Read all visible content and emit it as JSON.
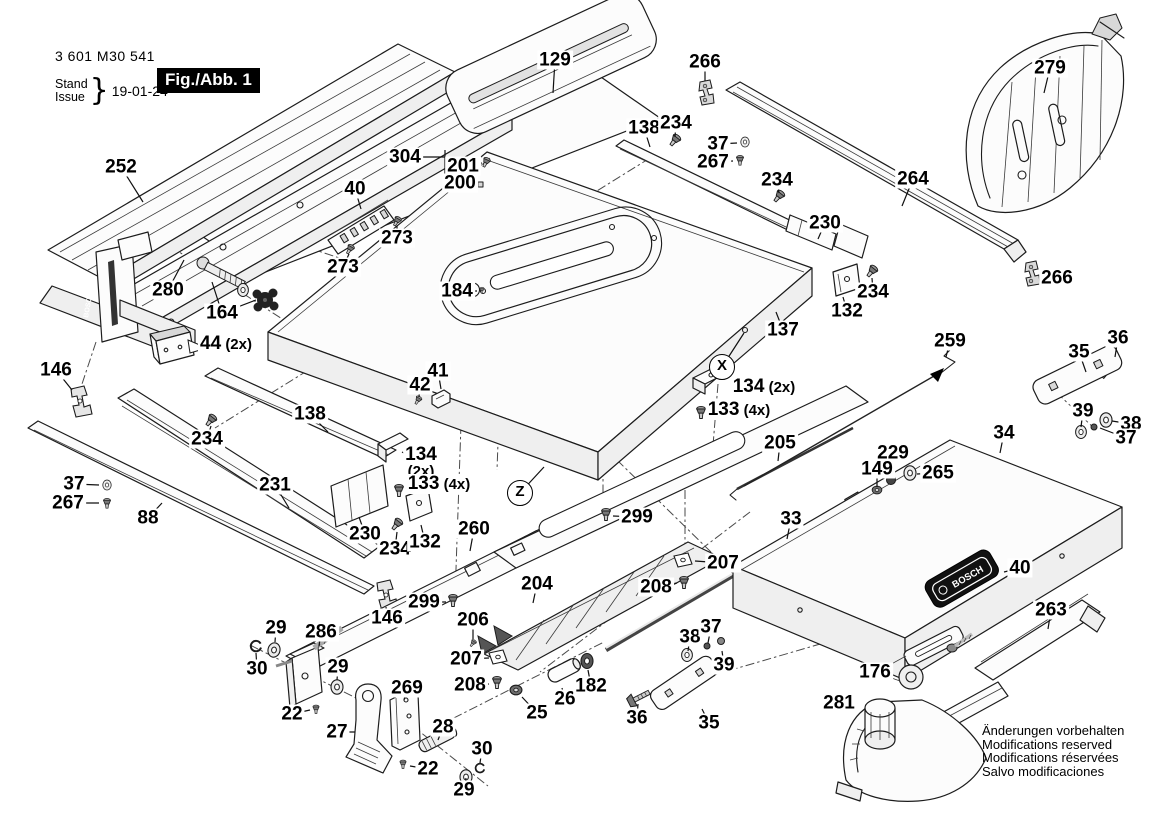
{
  "header": {
    "part_number": "3 601 M30 541",
    "stand_label": "Stand",
    "issue_label": "Issue",
    "date": "19-01-24",
    "figure": "Fig./Abb. 1"
  },
  "brand": "BOSCH",
  "notes": [
    "Änderungen vorbehalten",
    "Modifications reserved",
    "Modifications réservées",
    "Salvo modificaciones"
  ],
  "circled_refs": [
    {
      "t": "X",
      "x": 722,
      "y": 367,
      "lx": 744,
      "ly": 333
    },
    {
      "t": "Z",
      "x": 520,
      "y": 493,
      "lx": 544,
      "ly": 467
    }
  ],
  "callouts": [
    {
      "t": "252",
      "x": 121,
      "y": 167,
      "lx": 143,
      "ly": 202
    },
    {
      "t": "280",
      "x": 168,
      "y": 290,
      "lx": 184,
      "ly": 260
    },
    {
      "t": "164",
      "x": 222,
      "y": 313,
      "lx": 212,
      "ly": 282,
      "l2x": 256,
      "l2y": 300
    },
    {
      "t": "44",
      "s": "(2x)",
      "x": 226,
      "y": 344,
      "lx": 203,
      "ly": 347
    },
    {
      "t": "146",
      "x": 56,
      "y": 370,
      "lx": 72,
      "ly": 390
    },
    {
      "t": "37",
      "x": 74,
      "y": 484,
      "lx": 99,
      "ly": 485
    },
    {
      "t": "267",
      "x": 68,
      "y": 503,
      "lx": 99,
      "ly": 503
    },
    {
      "t": "88",
      "x": 148,
      "y": 518,
      "lx": 162,
      "ly": 503
    },
    {
      "t": "231",
      "x": 275,
      "y": 485,
      "lx": 289,
      "ly": 508
    },
    {
      "t": "234",
      "x": 207,
      "y": 439,
      "lx": 211,
      "ly": 426
    },
    {
      "t": "138",
      "x": 310,
      "y": 414,
      "lx": 328,
      "ly": 432
    },
    {
      "t": "273",
      "x": 397,
      "y": 238,
      "lx": 397,
      "ly": 226
    },
    {
      "t": "273",
      "x": 343,
      "y": 267,
      "lx": 349,
      "ly": 254
    },
    {
      "t": "40",
      "x": 355,
      "y": 189,
      "lx": 361,
      "ly": 209
    },
    {
      "t": "304",
      "x": 405,
      "y": 157,
      "lx": 420,
      "ly": 157
    },
    {
      "t": "201",
      "x": 463,
      "y": 166,
      "lx": 482,
      "ly": 163
    },
    {
      "t": "200",
      "x": 460,
      "y": 183,
      "lx": 477,
      "ly": 184
    },
    {
      "t": "129",
      "x": 555,
      "y": 60,
      "lx": 553,
      "ly": 93
    },
    {
      "t": "266",
      "x": 705,
      "y": 62,
      "lx": 705,
      "ly": 81
    },
    {
      "t": "138",
      "x": 644,
      "y": 128,
      "lx": 650,
      "ly": 147
    },
    {
      "t": "234",
      "x": 676,
      "y": 123,
      "lx": 675,
      "ly": 137
    },
    {
      "t": "37",
      "x": 718,
      "y": 144,
      "lx": 737,
      "ly": 143
    },
    {
      "t": "267",
      "x": 713,
      "y": 162,
      "lx": 733,
      "ly": 161
    },
    {
      "t": "234",
      "x": 777,
      "y": 180,
      "lx": 779,
      "ly": 193
    },
    {
      "t": "264",
      "x": 913,
      "y": 179,
      "lx": 902,
      "ly": 206
    },
    {
      "t": "279",
      "x": 1050,
      "y": 68,
      "lx": 1044,
      "ly": 93
    },
    {
      "t": "266",
      "x": 1057,
      "y": 278,
      "lx": 1043,
      "ly": 276
    },
    {
      "t": "230",
      "x": 825,
      "y": 223,
      "lx": 818,
      "ly": 239
    },
    {
      "t": "234",
      "x": 873,
      "y": 292,
      "lx": 872,
      "ly": 278
    },
    {
      "t": "132",
      "x": 847,
      "y": 311,
      "lx": 843,
      "ly": 297
    },
    {
      "t": "137",
      "x": 783,
      "y": 330,
      "lx": 776,
      "ly": 312
    },
    {
      "t": "134",
      "s": "(2x)",
      "x": 764,
      "y": 387,
      "lx": 731,
      "ly": 383
    },
    {
      "t": "133",
      "s": "(4x)",
      "x": 739,
      "y": 410,
      "lx": 709,
      "ly": 411
    },
    {
      "t": "259",
      "x": 950,
      "y": 341,
      "lx": 946,
      "ly": 357
    },
    {
      "t": "36",
      "x": 1118,
      "y": 338,
      "lx": 1115,
      "ly": 357
    },
    {
      "t": "35",
      "x": 1079,
      "y": 352,
      "lx": 1086,
      "ly": 372
    },
    {
      "t": "39",
      "x": 1083,
      "y": 411,
      "lx": 1081,
      "ly": 427
    },
    {
      "t": "38",
      "x": 1131,
      "y": 424,
      "lx": 1112,
      "ly": 421
    },
    {
      "t": "37",
      "x": 1126,
      "y": 438,
      "lx": 1100,
      "ly": 428
    },
    {
      "t": "34",
      "x": 1004,
      "y": 433,
      "lx": 1000,
      "ly": 453
    },
    {
      "t": "205",
      "x": 780,
      "y": 443,
      "lx": 778,
      "ly": 461
    },
    {
      "t": "229",
      "x": 893,
      "y": 453,
      "lx": 891,
      "ly": 476
    },
    {
      "t": "149",
      "x": 877,
      "y": 469,
      "lx": 877,
      "ly": 487
    },
    {
      "t": "265",
      "x": 938,
      "y": 473,
      "lx": 917,
      "ly": 474
    },
    {
      "t": "184",
      "x": 457,
      "y": 291,
      "lx": 477,
      "ly": 291
    },
    {
      "t": "41",
      "x": 438,
      "y": 371,
      "lx": 441,
      "ly": 389
    },
    {
      "t": "42",
      "x": 420,
      "y": 385,
      "lx": 419,
      "ly": 397
    },
    {
      "t": "134",
      "stk": "(2x)",
      "x": 421,
      "y": 462,
      "lx": 402,
      "ly": 452
    },
    {
      "t": "133",
      "s": "(4x)",
      "x": 439,
      "y": 484,
      "lx": 406,
      "ly": 489
    },
    {
      "t": "230",
      "x": 365,
      "y": 534,
      "lx": 359,
      "ly": 517
    },
    {
      "t": "234",
      "x": 395,
      "y": 549,
      "lx": 397,
      "ly": 532
    },
    {
      "t": "132",
      "x": 425,
      "y": 542,
      "lx": 421,
      "ly": 525
    },
    {
      "t": "260",
      "x": 474,
      "y": 529,
      "lx": 470,
      "ly": 551
    },
    {
      "t": "299",
      "x": 637,
      "y": 517,
      "lx": 613,
      "ly": 516
    },
    {
      "t": "33",
      "x": 791,
      "y": 519,
      "lx": 787,
      "ly": 539
    },
    {
      "t": "204",
      "x": 537,
      "y": 584,
      "lx": 533,
      "ly": 603
    },
    {
      "t": "207",
      "x": 723,
      "y": 563,
      "lx": 695,
      "ly": 561
    },
    {
      "t": "208",
      "x": 656,
      "y": 587,
      "lx": 677,
      "ly": 583
    },
    {
      "t": "299",
      "x": 424,
      "y": 602,
      "lx": 446,
      "ly": 602
    },
    {
      "t": "146",
      "x": 387,
      "y": 618,
      "lx": 386,
      "ly": 607
    },
    {
      "t": "206",
      "x": 473,
      "y": 620,
      "lx": 473,
      "ly": 639
    },
    {
      "t": "207",
      "x": 466,
      "y": 659,
      "lx": 489,
      "ly": 658
    },
    {
      "t": "208",
      "x": 470,
      "y": 685,
      "lx": 489,
      "ly": 684
    },
    {
      "t": "29",
      "x": 276,
      "y": 628,
      "lx": 275,
      "ly": 642
    },
    {
      "t": "286",
      "x": 321,
      "y": 632,
      "lx": 319,
      "ly": 646
    },
    {
      "t": "30",
      "x": 257,
      "y": 669,
      "lx": 256,
      "ly": 653
    },
    {
      "t": "29",
      "x": 338,
      "y": 667,
      "lx": 337,
      "ly": 680
    },
    {
      "t": "22",
      "x": 292,
      "y": 714,
      "lx": 310,
      "ly": 710
    },
    {
      "t": "27",
      "x": 337,
      "y": 732,
      "lx": 355,
      "ly": 732
    },
    {
      "t": "269",
      "x": 407,
      "y": 688,
      "lx": 404,
      "ly": 700
    },
    {
      "t": "28",
      "x": 443,
      "y": 727,
      "lx": 438,
      "ly": 740
    },
    {
      "t": "22",
      "x": 428,
      "y": 769,
      "lx": 410,
      "ly": 766
    },
    {
      "t": "30",
      "x": 482,
      "y": 749,
      "lx": 480,
      "ly": 763
    },
    {
      "t": "29",
      "x": 464,
      "y": 790,
      "lx": 466,
      "ly": 778
    },
    {
      "t": "25",
      "x": 537,
      "y": 713,
      "lx": 522,
      "ly": 697
    },
    {
      "t": "26",
      "x": 565,
      "y": 699,
      "lx": 562,
      "ly": 688
    },
    {
      "t": "182",
      "x": 591,
      "y": 686,
      "lx": 588,
      "ly": 670
    },
    {
      "t": "36",
      "x": 637,
      "y": 718,
      "lx": 638,
      "ly": 704
    },
    {
      "t": "35",
      "x": 709,
      "y": 723,
      "lx": 702,
      "ly": 709
    },
    {
      "t": "38",
      "x": 690,
      "y": 637,
      "lx": 688,
      "ly": 651
    },
    {
      "t": "37",
      "x": 711,
      "y": 627,
      "lx": 708,
      "ly": 643
    },
    {
      "t": "39",
      "x": 724,
      "y": 665,
      "lx": 722,
      "ly": 651
    },
    {
      "t": "40",
      "x": 1020,
      "y": 568,
      "lx": 1004,
      "ly": 572
    },
    {
      "t": "263",
      "x": 1051,
      "y": 610,
      "lx": 1048,
      "ly": 629
    },
    {
      "t": "176",
      "x": 875,
      "y": 672,
      "lx": 891,
      "ly": 672
    },
    {
      "t": "281",
      "x": 839,
      "y": 703,
      "lx": 857,
      "ly": 704
    }
  ]
}
